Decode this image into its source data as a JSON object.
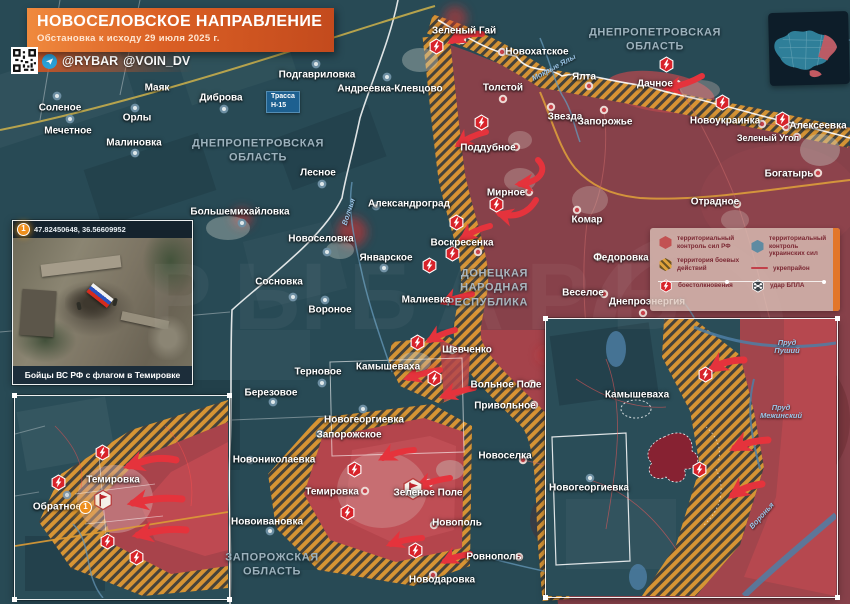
{
  "banner": {
    "title": "НОВОСЕЛОВСКОЕ НАПРАВЛЕНИЕ",
    "subtitle": "Обстановка к исходу 29 июля 2025 г."
  },
  "credits": {
    "telegram1": "@RYBAR",
    "telegram2": "@VOIN_DV"
  },
  "watermark": "РЫБАРЬ",
  "region_labels": {
    "dnipro": "ДНЕПРОПЕТРОВСКАЯ ОБЛАСТЬ",
    "zapor": "ЗАПОРОЖСКАЯ ОБЛАСТЬ",
    "dnr": "ДОНЕЦКАЯ НАРОДНАЯ РЕСПУБЛИКА"
  },
  "road_sign": {
    "line1": "Трасса",
    "line2": "Н-15"
  },
  "settlements": {
    "solenoe": "Соленое",
    "mechetnoe": "Мечетное",
    "orly": "Орлы",
    "malinovka": "Малиновка",
    "mayak": "Маяк",
    "dibrova": "Диброва",
    "podgavrilovka": "Подгавриловка",
    "andreevka": "Андреевка-Клевцово",
    "lesnoe": "Лесное",
    "bolshemikhaylovka": "Большемихайловка",
    "novoselovka": "Новоселовка",
    "aleksandrograd": "Александроград",
    "yanvarskoe": "Январское",
    "sosnovka": "Сосновка",
    "voronoe": "Вороное",
    "voskresenka": "Воскресенка",
    "malievka": "Малиевка",
    "shevchenko": "Шевченко",
    "ternovoe": "Терновое",
    "berezovoe": "Березовое",
    "kamyshevakha": "Камышеваха",
    "novogeorgievka": "Новогеоргиевка",
    "zaporozhskoe": "Запорожское",
    "novonikolaevka": "Новониколаевка",
    "novoivanovka": "Новоивановка",
    "temirovka": "Темировка",
    "zelenoe_pole": "Зеленое Поле",
    "novopol": "Новополь",
    "rovnopol": "Ровнополь",
    "novodarovka": "Новодаровка",
    "novoselka": "Новоселка",
    "volnoe_pole": "Вольное Поле",
    "privolnoe": "Привольное",
    "zeleny_gay": "Зеленый Гай",
    "novokhatskoe": "Новохатское",
    "yalta": "Ялта",
    "dachnoe": "Дачное",
    "tolstoy": "Толстой",
    "zvezda": "Звезда",
    "zaporozhye": "Запорожье",
    "novoukrainka": "Новоукраинка",
    "zeleny_ugol": "Зеленый Угол",
    "alekseevka": "Алексеевка",
    "poddubnoe": "Поддубное",
    "mirnoe": "Мирное",
    "komar": "Комар",
    "otradnoe": "Отрадное",
    "bogatyr": "Богатырь",
    "fedorovka": "Федоровка",
    "veseloe": "Веселое",
    "dneproenergia": "Днепроэнергия",
    "obratnoe": "Обратное"
  },
  "waters": {
    "mokrye_yaly": "Мокрые Ялы",
    "volchya": "Волчья",
    "voronya": "Воронья",
    "prud_pushiy": "Пруд Пуший",
    "prud_mezhinskiy": "Пруд Межинский"
  },
  "legend": {
    "rf_control": "территориальный контроль сил РФ",
    "ua_control": "территориальный контроль украинских сил",
    "combat_zone": "территория боевых действий",
    "fortified": "укрепрайон",
    "clashes": "боестолкновения",
    "uav": "удар БПЛА"
  },
  "photo_inset": {
    "coordinates": "47.82450648, 36.56609952",
    "caption": "Бойцы ВС РФ с флагом в Темировке"
  },
  "markers": {
    "one": "1"
  },
  "colors": {
    "ua_zone": "#2a4d58",
    "rf_zone": "#8d4149",
    "rf_recent": "#b5444c",
    "combat_zone": "#dd9733",
    "accent": "#e2762a"
  }
}
